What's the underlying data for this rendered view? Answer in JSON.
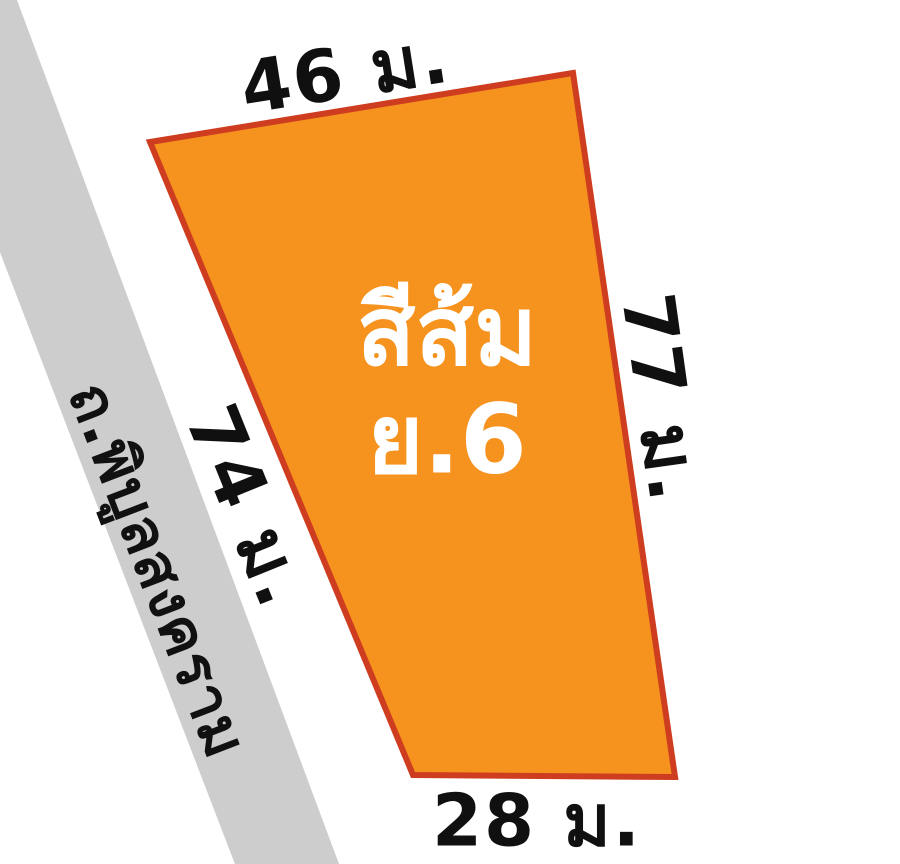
{
  "background_color": "#FFFFFF",
  "plot": {
    "zone_label_line1": "สีส้ม",
    "zone_label_line2": "ย.6",
    "fill_color": "#F6921E",
    "border_color": "#CE3D20",
    "label_color": "#FFFFFF"
  },
  "dimensions": {
    "top": "46 ม.",
    "right": "77 ม.",
    "bottom": "28 ม.",
    "left": "74 ม."
  },
  "road": {
    "name": "ถ.พิบูลสงคราม",
    "fill_color": "#CDCDCD",
    "text_color": "#111111"
  }
}
